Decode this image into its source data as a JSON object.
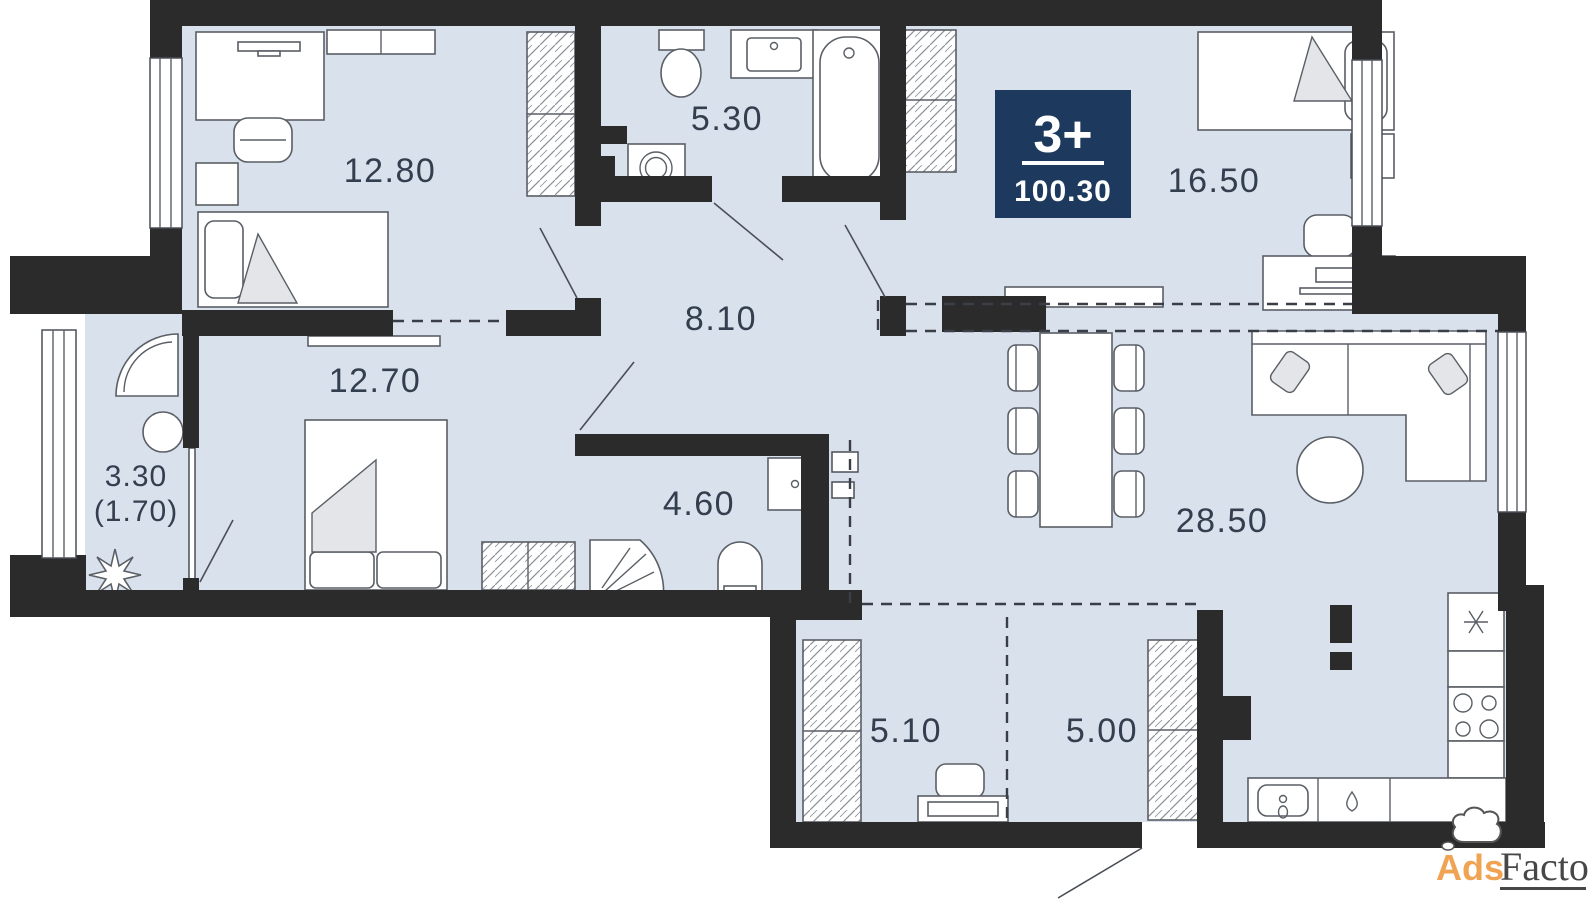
{
  "plan": {
    "badge": {
      "rooms_label": "3+",
      "total_area": "100.30"
    },
    "rooms": [
      {
        "name": "bedroom-top-left",
        "area": "12.80"
      },
      {
        "name": "bathroom",
        "area": "5.30"
      },
      {
        "name": "bedroom-top-right",
        "area": "16.50"
      },
      {
        "name": "hallway",
        "area": "8.10"
      },
      {
        "name": "bedroom-left",
        "area": "12.70"
      },
      {
        "name": "balcony",
        "area": "3.30",
        "area_reduced": "(1.70)"
      },
      {
        "name": "shower-room",
        "area": "4.60"
      },
      {
        "name": "living-room",
        "area": "28.50"
      },
      {
        "name": "wardrobe-room",
        "area": "5.10"
      },
      {
        "name": "entry-hall",
        "area": "5.00"
      }
    ],
    "colors": {
      "wall": "#2b2b2b",
      "floor": "#d9e1ed",
      "badge_bg": "#1d3a5e",
      "badge_text": "#ffffff",
      "label_text": "#333f4e",
      "watermark_orange": "#f0a352",
      "watermark_gray": "#474747"
    }
  },
  "watermark": {
    "brand_left": "Ads",
    "brand_right": "Factory"
  }
}
